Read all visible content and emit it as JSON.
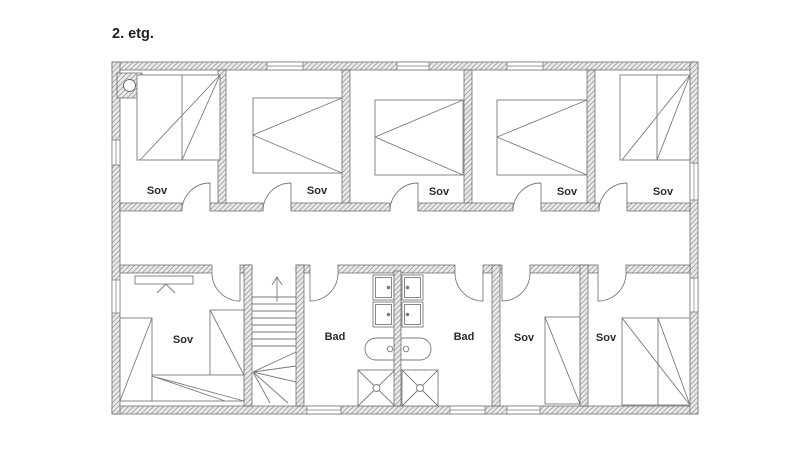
{
  "title": "2. etg.",
  "colors": {
    "background": "#ffffff",
    "wall_fill": "#e9e9e9",
    "wall_hatch": "#a0a0a0",
    "wall_outline": "#616161",
    "drawing_line": "#7a7a7a",
    "text": "#1f1f1f"
  },
  "rooms": [
    {
      "id": "bedroom-top-1",
      "label": "Sov"
    },
    {
      "id": "bedroom-top-2",
      "label": "Sov"
    },
    {
      "id": "bedroom-top-3",
      "label": "Sov"
    },
    {
      "id": "bedroom-top-4",
      "label": "Sov"
    },
    {
      "id": "bedroom-top-5",
      "label": "Sov"
    },
    {
      "id": "bedroom-bottom-left",
      "label": "Sov"
    },
    {
      "id": "bathroom-left",
      "label": "Bad"
    },
    {
      "id": "bathroom-right",
      "label": "Bad"
    },
    {
      "id": "bedroom-bottom-mid",
      "label": "Sov"
    },
    {
      "id": "bedroom-bottom-right",
      "label": "Sov"
    }
  ],
  "fixtures": [
    "chimney",
    "staircase",
    "stair-direction-arrow",
    "bed",
    "wardrobe",
    "sink",
    "toilet",
    "shower",
    "window",
    "door"
  ]
}
